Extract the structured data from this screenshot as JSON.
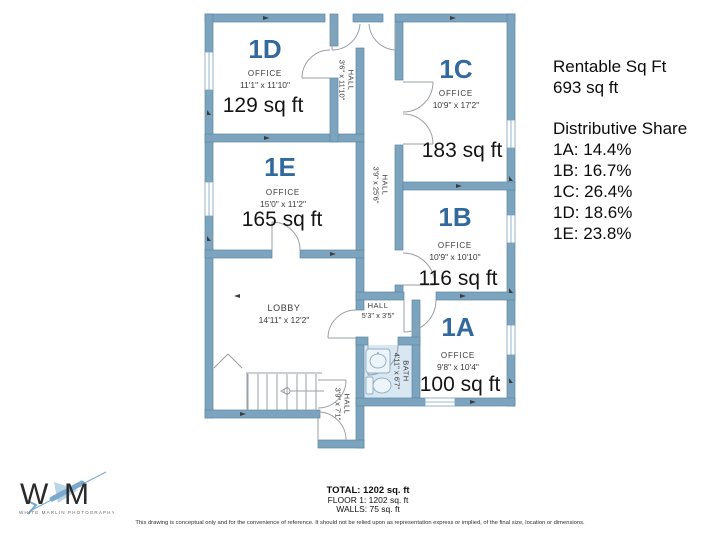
{
  "colors": {
    "wall": "#7ca4bf",
    "wall_edge": "#5d87a3",
    "room_id": "#336a9e",
    "bath_fill": "#d9e7f2"
  },
  "plan": {
    "rooms": {
      "1D": {
        "id": "1D",
        "type": "OFFICE",
        "dims": "11'1\" x 11'10\"",
        "area": "129 sq ft"
      },
      "1E": {
        "id": "1E",
        "type": "OFFICE",
        "dims": "15'0\" x 11'2\"",
        "area": "165 sq ft"
      },
      "1C": {
        "id": "1C",
        "type": "OFFICE",
        "dims": "10'9\" x 17'2\"",
        "area": "183 sq ft"
      },
      "1B": {
        "id": "1B",
        "type": "OFFICE",
        "dims": "10'9\" x 10'10\"",
        "area": "116 sq ft"
      },
      "1A": {
        "id": "1A",
        "type": "OFFICE",
        "dims": "9'8\" x 10'4\"",
        "area": "100 sq ft"
      }
    },
    "spaces": {
      "lobby": {
        "name": "LOBBY",
        "dims": "14'11\" x 12'2\""
      },
      "hall_top": {
        "name": "HALL",
        "dims": "3'6\" x 11'10\""
      },
      "hall_main": {
        "name": "HALL",
        "dims": "3'9\" x 25'6\""
      },
      "hall_small": {
        "name": "HALL",
        "dims": "5'3\" x 3'5\""
      },
      "bath": {
        "name": "BATH",
        "dims": "4'11\" x 6'7\""
      },
      "hall_stairs": {
        "name": "HALL",
        "dims": "3'9\" x 7'1\""
      }
    }
  },
  "sidebar": {
    "rentable_title": "Rentable Sq Ft",
    "rentable_value": "693 sq ft",
    "share_title": "Distributive Share",
    "shares": [
      "1A: 14.4%",
      "1B: 16.7%",
      "1C: 26.4%",
      "1D: 18.6%",
      "1E:  23.8%"
    ]
  },
  "footer": {
    "total": "TOTAL: 1202 sq. ft",
    "floor": "FLOOR 1: 1202 sq. ft",
    "walls": "WALLS: 75 sq. ft",
    "disclaimer": "This drawing is conceptual only and for the convenience of reference. It should not be relied upon as representation express or implied, of the final size, location or dimensions."
  },
  "logo": {
    "letter_w": "W",
    "letter_m": "M",
    "caption": "WHITE MARLIN PHOTOGRAPHY"
  }
}
